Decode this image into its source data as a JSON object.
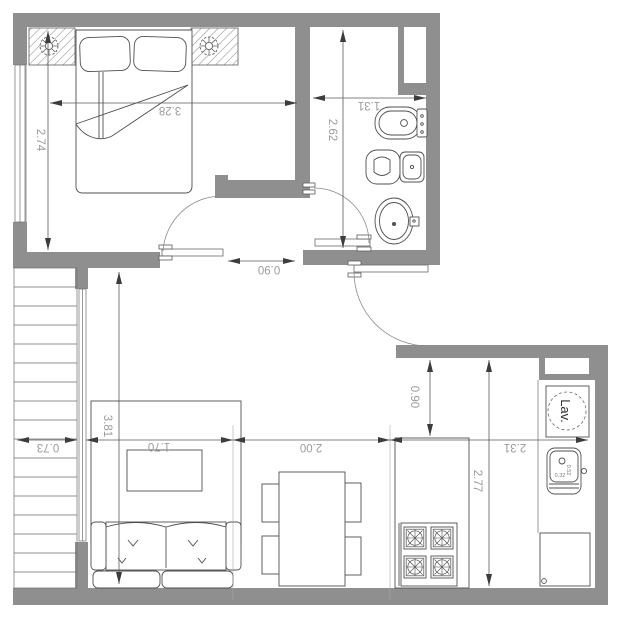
{
  "dimensions": {
    "bedroom_width": "3.28",
    "bedroom_depth": "2.74",
    "bathroom_width": "1.31",
    "bathroom_depth": "2.62",
    "bedroom_door_width": "0.90",
    "stairs_width": "0.73",
    "living_length": "3.81",
    "rug_width": "1.70",
    "dining_width": "2.00",
    "kitchen_width": "2.31",
    "kitchen_depth": "2.77",
    "kitchen_passage_width": "0.90",
    "kitchen_sink_width": "0.32",
    "kitchen_sink_depth": "0.52"
  },
  "labels": {
    "laundry": "Lav."
  },
  "colors": {
    "wall_fill": "#8f8f8f",
    "furniture_line": "#4f4f4f",
    "dimension_text": "#9b9b9b",
    "background": "#ffffff"
  }
}
